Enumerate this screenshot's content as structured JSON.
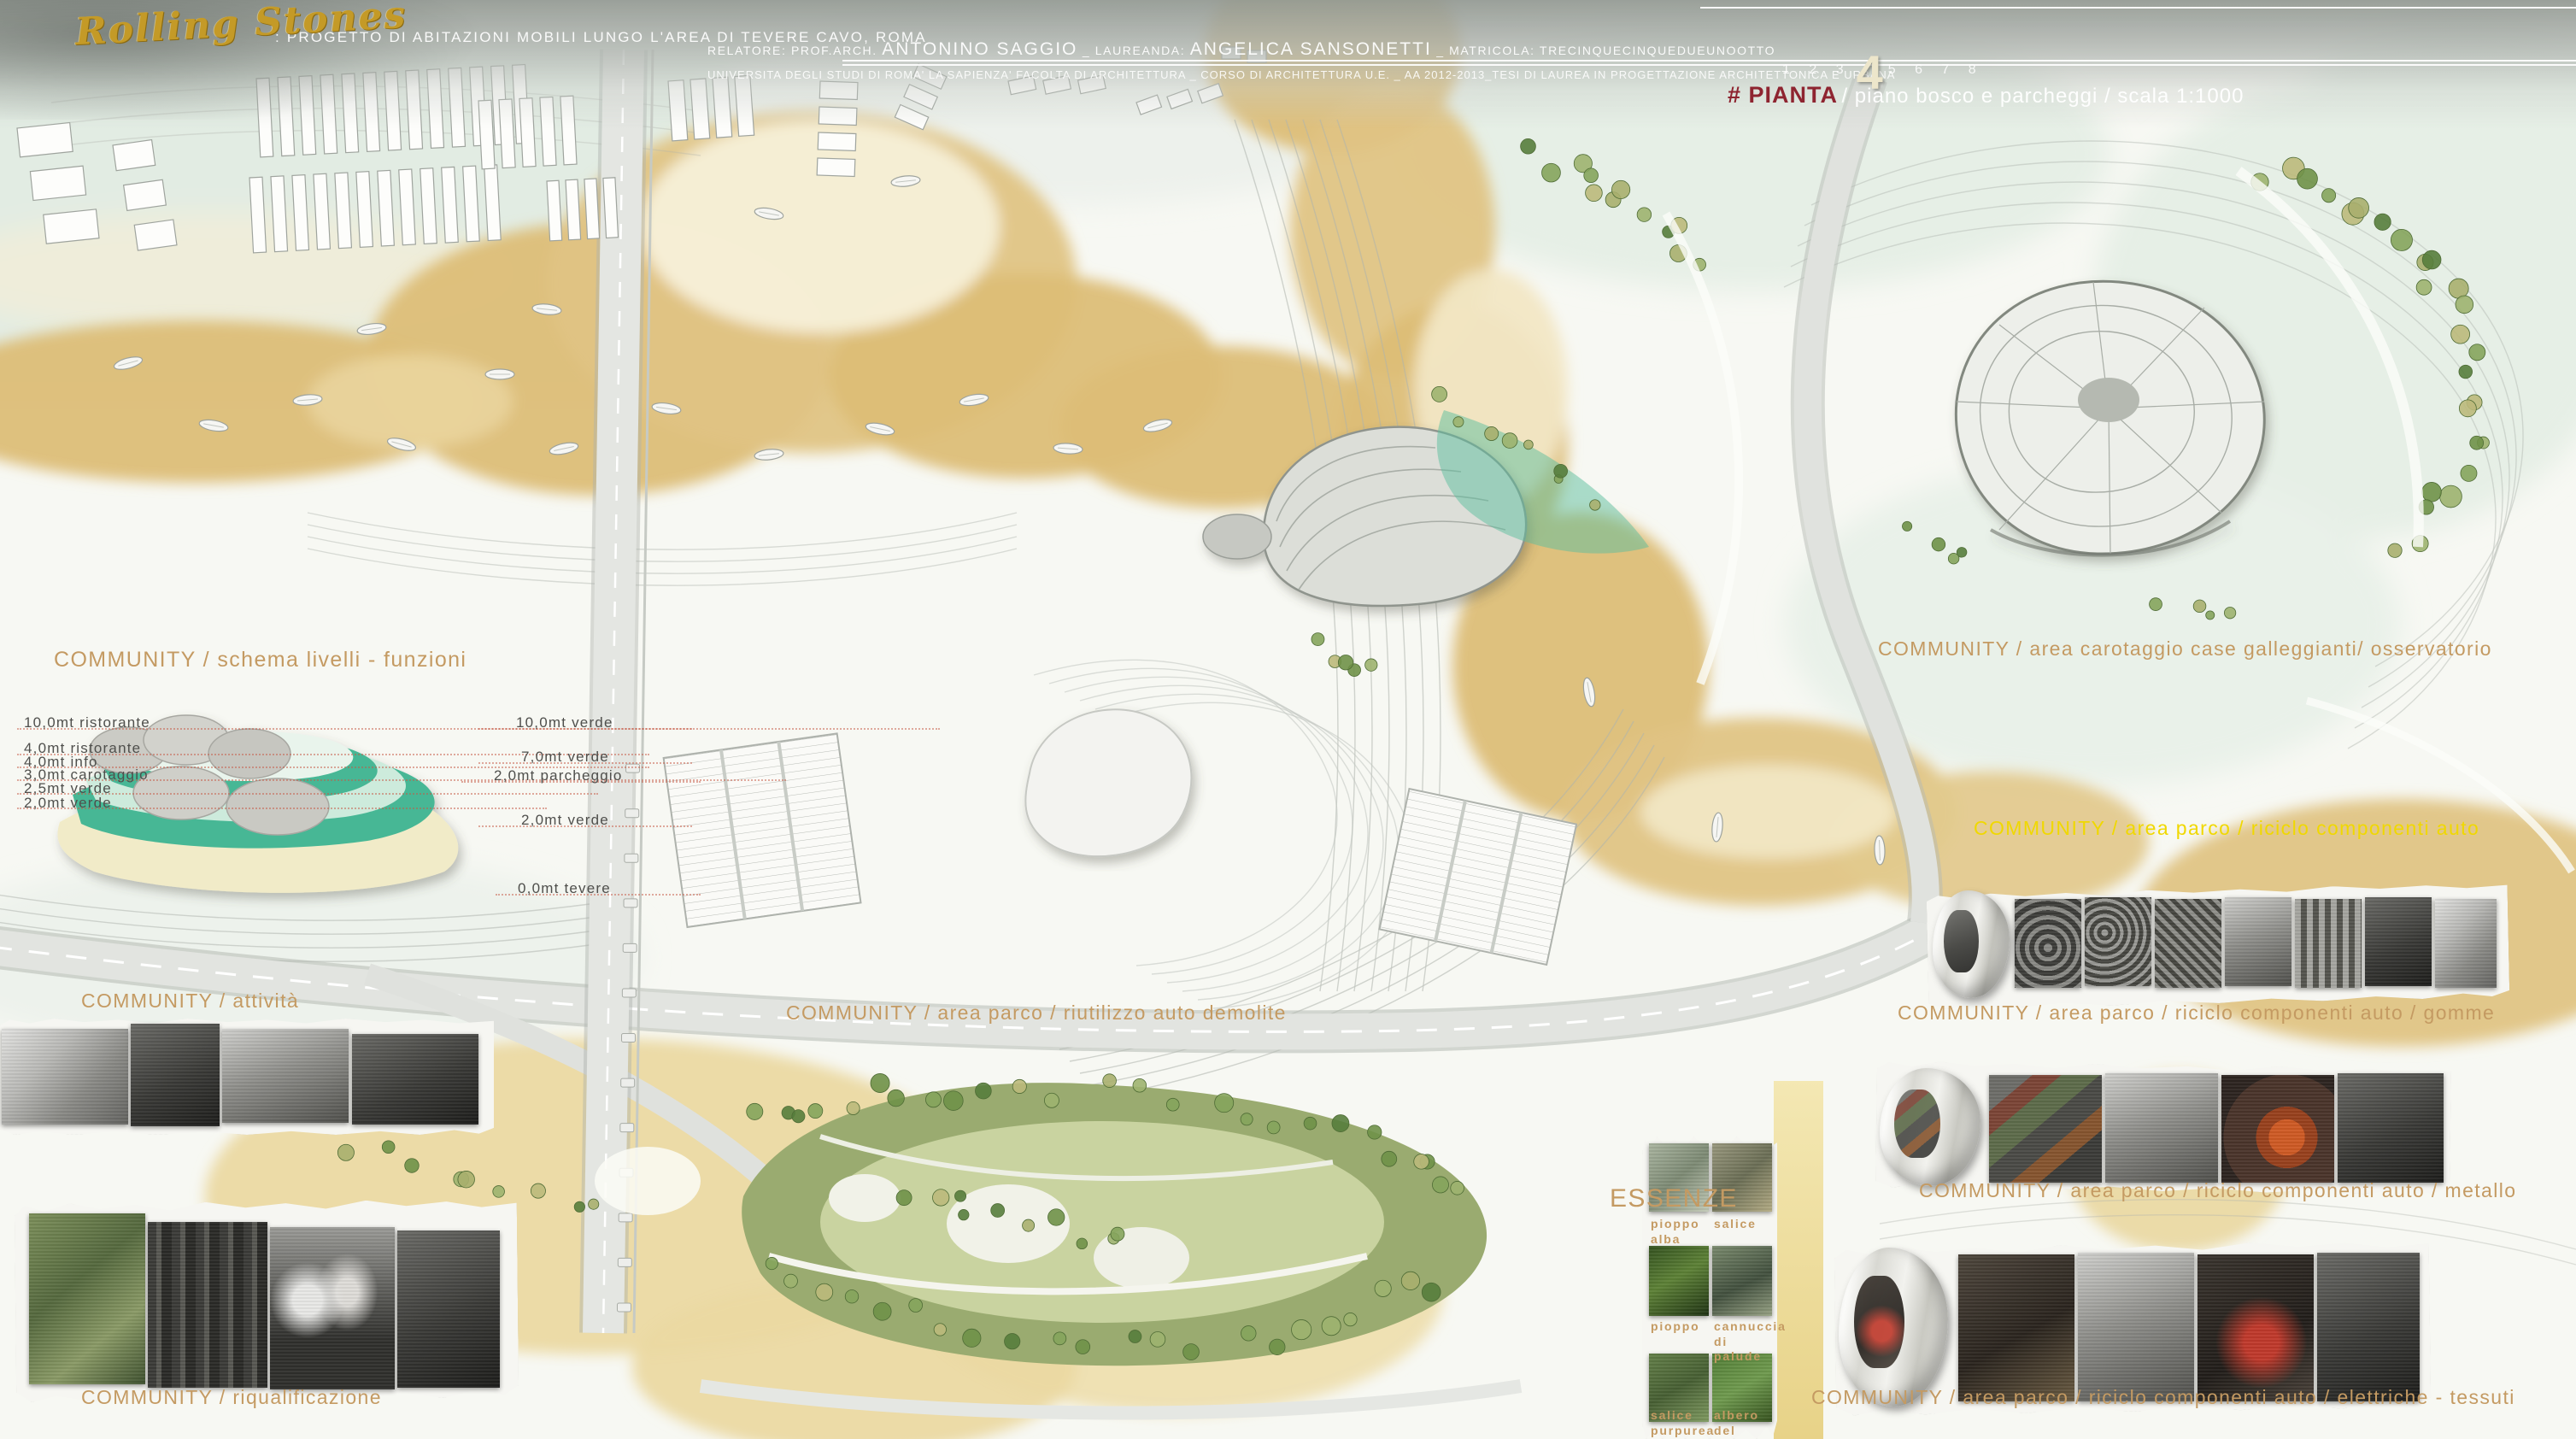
{
  "header": {
    "logo": "Rolling Stones",
    "project_line": ": PROGETTO DI ABITAZIONI MOBILI LUNGO L'AREA DI TEVERE CAVO, ROMA",
    "credits": [
      {
        "t": "RELATORE: PROF.ARCH. "
      },
      {
        "t": "ANTONINO SAGGIO"
      },
      {
        "t": " _ LAUREANDA: "
      },
      {
        "t": "ANGELICA SANSONETTI"
      },
      {
        "t": " _ MATRICOLA: "
      },
      {
        "t": "TRECINQUECINQUEDUEUNOOTTO"
      }
    ],
    "university_line": "UNIVERSITA DEGLI STUDI DI ROMA' LA SAPIENZA' FACOLTA DI ARCHITETTURA _ CORSO DI ARCHITETTURA U.E. _ AA 2012-2013_TESI DI LAUREA IN PROGETTAZIONE ARCHITETTONICA E URBANA",
    "pages_before": "1 2 3",
    "page_current": "4",
    "pages_after": "5 6 7 8",
    "sheet_tag": "# PIANTA",
    "sheet_subtitle": " / piano bosco e parcheggi / scala 1:1000"
  },
  "labels": {
    "schema": "COMMUNITY / schema livelli - funzioni",
    "attivita": "COMMUNITY /  attività",
    "riutilizzo": "COMMUNITY / area parco / riutilizzo auto demolite",
    "carotaggio": "COMMUNITY / area carotaggio case galleggianti/ osservatorio",
    "riciclo": "COMMUNITY / area parco / riciclo componenti auto",
    "gomme": "COMMUNITY / area parco / riciclo componenti auto / gomme",
    "metallo": "COMMUNITY / area parco / riciclo componenti auto / metallo",
    "elettriche": "COMMUNITY / area parco / riciclo componenti auto / elettriche - tessuti",
    "riqualificazione": "COMMUNITY / riqualificazione",
    "essenze": "ESSENZE"
  },
  "levels": {
    "left": [
      "10,0mt ristorante",
      "4,0mt ristorante",
      "4,0mt info",
      "3,0mt carotaggio",
      "2,5mt verde",
      "2,0mt verde"
    ],
    "right": [
      "10,0mt verde",
      "7,0mt verde",
      "2,0mt parcheggio",
      "2,0mt verde",
      "0,0mt tevere"
    ]
  },
  "essenze_items": [
    "pioppo alba",
    "salice",
    "pioppo",
    "cannuccia di palude",
    "salice purpurea",
    "albero del paradiso"
  ],
  "colors": {
    "label_tan": "#C49A62",
    "label_yellow": "#F0D800",
    "sheet_red": "#8E2430",
    "river_tan": "#DDBE77",
    "teal_accent": "#46B795",
    "logo_gold": "#C49A27"
  }
}
